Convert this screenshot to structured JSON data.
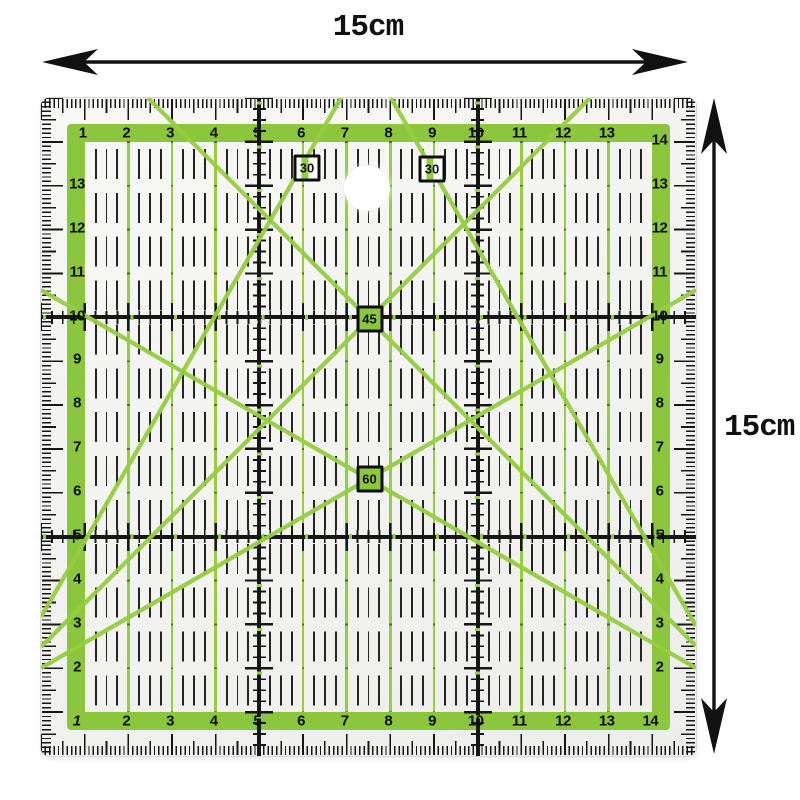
{
  "annotations": {
    "width_label": "15cm",
    "height_label": "15cm"
  },
  "ruler": {
    "angle_markers": [
      {
        "label": "30"
      },
      {
        "label": "30"
      },
      {
        "label": "45"
      },
      {
        "label": "60"
      }
    ],
    "scales": {
      "top": [
        "1",
        "2",
        "3",
        "4",
        "5",
        "6",
        "7",
        "8",
        "9",
        "10",
        "11",
        "12",
        "13"
      ],
      "right": [
        "14",
        "13",
        "12",
        "11",
        "10",
        "9",
        "8",
        "7",
        "6",
        "5",
        "4",
        "3",
        "2"
      ],
      "left": [
        "13",
        "12",
        "11",
        "10",
        "9",
        "8",
        "7",
        "6",
        "5",
        "4",
        "3",
        "2"
      ],
      "bottom": [
        "1",
        "2",
        "3",
        "4",
        "5",
        "6",
        "7",
        "8",
        "9",
        "10",
        "11",
        "12",
        "13",
        "14"
      ]
    },
    "colors": {
      "grid_green": "#8CC63C",
      "line_green": "#96CE41",
      "mark_black": "#161616",
      "body": "#f6f6f4"
    }
  }
}
